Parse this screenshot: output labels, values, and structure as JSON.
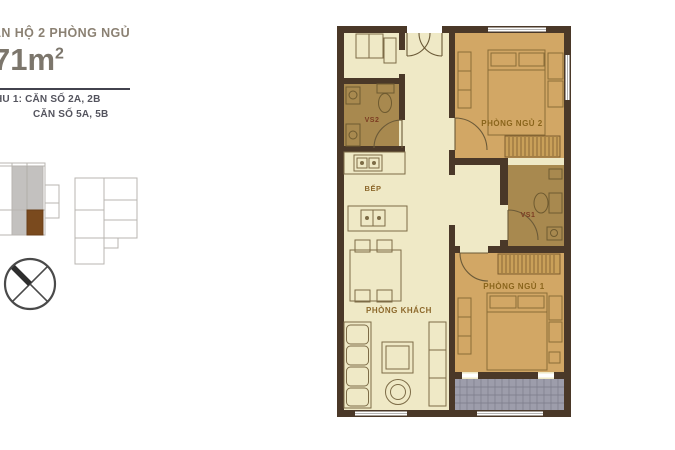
{
  "header": {
    "apartment_type": "ĂN HỘ 2 PHÒNG NGỦ",
    "area_value": "71m",
    "area_superscript": "2",
    "unit_line_1": "HU 1: CĂN SỐ 2A, 2B",
    "unit_line_2": "CĂN SỐ 5A, 5B"
  },
  "floorplan": {
    "rooms": [
      {
        "name": "bathroom-2",
        "label": "VS2"
      },
      {
        "name": "kitchen",
        "label": "BẾP"
      },
      {
        "name": "living-room",
        "label": "PHÒNG KHÁCH"
      },
      {
        "name": "bedroom-2",
        "label": "PHÒNG NGỦ 2"
      },
      {
        "name": "bathroom-1",
        "label": "VS1"
      },
      {
        "name": "bedroom-1",
        "label": "PHÒNG NGỦ 1"
      }
    ]
  },
  "colors": {
    "floor_common": "#efe9c6",
    "floor_bedroom": "#d2a765",
    "floor_bathroom": "#a8894f",
    "wall": "#4a3828",
    "balcony_floor": "#9d9dab",
    "keyplan_highlight_unit": "#7a4a1e",
    "keyplan_highlight_block": "#c3c1bf",
    "title_text": "#8b8173",
    "unit_text": "#54545e"
  }
}
